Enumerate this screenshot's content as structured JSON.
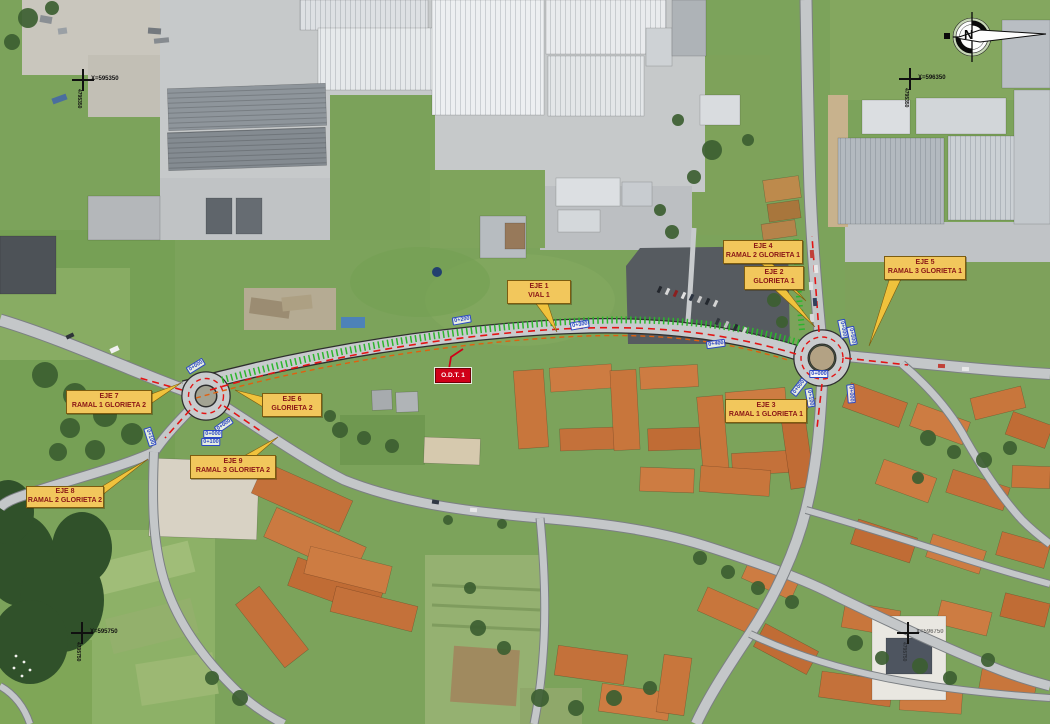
{
  "labels": [
    {
      "id": "eje1",
      "line1": "EJE 1",
      "line2": "VIAL 1"
    },
    {
      "id": "eje2",
      "line1": "EJE 2",
      "line2": "GLORIETA 1"
    },
    {
      "id": "eje3",
      "line1": "EJE 3",
      "line2": "RAMAL 1 GLORIETA 1"
    },
    {
      "id": "eje4",
      "line1": "EJE 4",
      "line2": "RAMAL 2 GLORIETA 1"
    },
    {
      "id": "eje5",
      "line1": "EJE 5",
      "line2": "RAMAL 3 GLORIETA 1"
    },
    {
      "id": "eje6",
      "line1": "EJE 6",
      "line2": "GLORIETA 2"
    },
    {
      "id": "eje7",
      "line1": "EJE 7",
      "line2": "RAMAL 1 GLORIETA 2"
    },
    {
      "id": "eje8",
      "line1": "EJE 8",
      "line2": "RAMAL 2 GLORIETA 2"
    },
    {
      "id": "eje9",
      "line1": "EJE 9",
      "line2": "RAMAL 3 GLORIETA 2"
    }
  ],
  "odt_label": "O.D.T. 1",
  "compass_letter": "N",
  "grid_crosses": [
    {
      "x": 83,
      "y": 80,
      "x_label": "X=595350",
      "y_label": "4795350",
      "faint": false
    },
    {
      "x": 910,
      "y": 79,
      "x_label": "X=596350",
      "y_label": "4795350",
      "faint": false
    },
    {
      "x": 82,
      "y": 633,
      "x_label": "X=595750",
      "y_label": "4795750",
      "faint": false
    },
    {
      "x": 908,
      "y": 633,
      "x_label": "X=596750",
      "y_label": "4795750",
      "faint": true
    }
  ],
  "chainage_markers": [
    {
      "text": "0+200",
      "x": 462,
      "y": 320,
      "rot": -10
    },
    {
      "text": "0+300",
      "x": 580,
      "y": 325,
      "rot": -10
    },
    {
      "text": "0+400",
      "x": 716,
      "y": 344,
      "rot": -8
    },
    {
      "text": "0+000",
      "x": 843,
      "y": 329,
      "rot": 78
    },
    {
      "text": "0+500",
      "x": 852,
      "y": 336,
      "rot": 78
    },
    {
      "text": "0+000",
      "x": 819,
      "y": 374,
      "rot": 0
    },
    {
      "text": "0+000",
      "x": 799,
      "y": 387,
      "rot": -52
    },
    {
      "text": "0+000",
      "x": 851,
      "y": 394,
      "rot": 85
    },
    {
      "text": "0+100",
      "x": 810,
      "y": 398,
      "rot": 80
    },
    {
      "text": "0+000",
      "x": 196,
      "y": 366,
      "rot": -32
    },
    {
      "text": "0+000",
      "x": 224,
      "y": 425,
      "rot": -35
    },
    {
      "text": "0+000",
      "x": 213,
      "y": 434,
      "rot": 0
    },
    {
      "text": "0+100",
      "x": 211,
      "y": 442,
      "rot": 0
    },
    {
      "text": "0+100",
      "x": 150,
      "y": 437,
      "rot": 72
    }
  ],
  "colors": {
    "label_bg": "#f2c75c",
    "label_text": "#8a1616",
    "axis_red": "#e31414",
    "embankment_green": "#2db52d",
    "chainage_blue": "#2b47c4",
    "odt_red": "#d00018"
  }
}
